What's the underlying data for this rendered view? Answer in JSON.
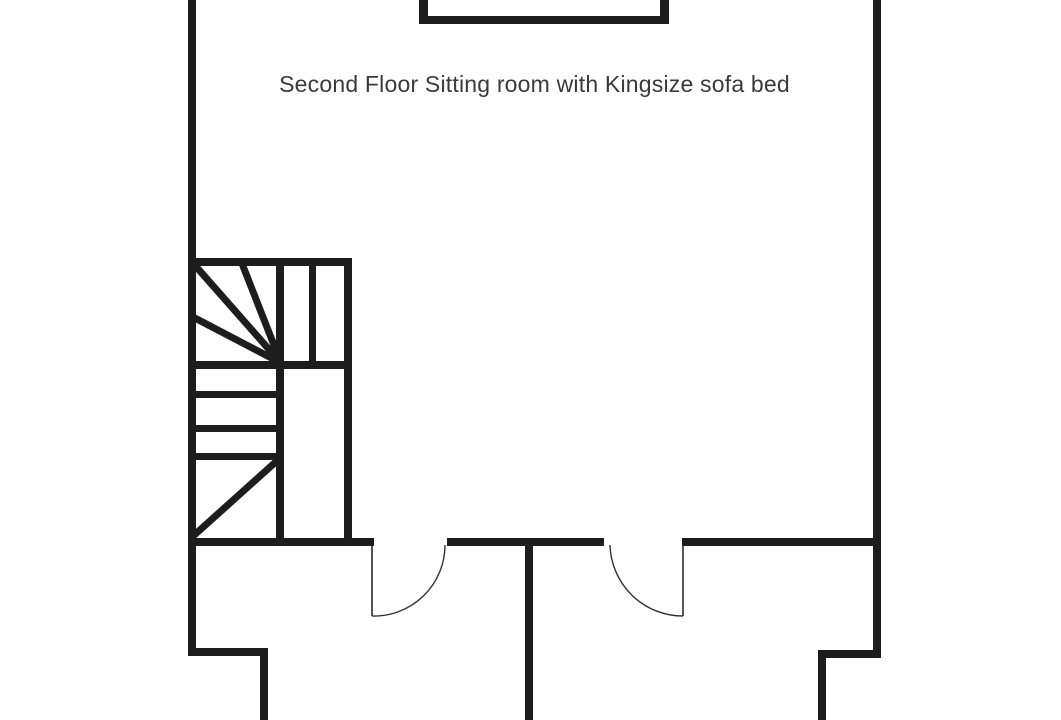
{
  "title": {
    "label": "Second Floor Sitting room with Kingsize sofa bed"
  },
  "colors": {
    "background": "#ffffff",
    "wall": "#1d1d1d",
    "door_leaf": "#555555",
    "door_arc": "#333333",
    "text": "#3a3a3a"
  },
  "floorplan": {
    "canvas": {
      "width": 1061,
      "height": 720
    },
    "winder_stroke_width": 7,
    "door_leaf_stroke_width": 2,
    "door_arc_stroke_width": 1.4,
    "walls": [
      {
        "name": "left-exterior-wall",
        "x": 188,
        "y": 0,
        "w": 8,
        "h": 656
      },
      {
        "name": "right-exterior-wall",
        "x": 873,
        "y": 0,
        "w": 8,
        "h": 658
      },
      {
        "name": "chimney-left-wall",
        "x": 419,
        "y": 0,
        "w": 9,
        "h": 24
      },
      {
        "name": "chimney-right-wall",
        "x": 660,
        "y": 0,
        "w": 9,
        "h": 24
      },
      {
        "name": "chimney-bottom-wall",
        "x": 419,
        "y": 16,
        "w": 250,
        "h": 8
      },
      {
        "name": "stair-top-edge",
        "x": 188,
        "y": 258,
        "w": 164,
        "h": 8
      },
      {
        "name": "stair-right-edge",
        "x": 344,
        "y": 258,
        "w": 8,
        "h": 288
      },
      {
        "name": "stair-center-divider",
        "x": 276,
        "y": 258,
        "w": 8,
        "h": 288
      },
      {
        "name": "stair-upper-riser",
        "x": 309,
        "y": 258,
        "w": 7,
        "h": 106
      },
      {
        "name": "stair-mid-landing-edge",
        "x": 188,
        "y": 361,
        "w": 164,
        "h": 8
      },
      {
        "name": "stair-tread-1",
        "x": 188,
        "y": 391,
        "w": 95,
        "h": 7
      },
      {
        "name": "stair-tread-2",
        "x": 188,
        "y": 425,
        "w": 95,
        "h": 7
      },
      {
        "name": "stair-tread-3",
        "x": 188,
        "y": 453,
        "w": 95,
        "h": 7
      },
      {
        "name": "hall-wall-left-segment",
        "x": 188,
        "y": 538,
        "w": 186,
        "h": 8
      },
      {
        "name": "hall-wall-middle-segment",
        "x": 447,
        "y": 538,
        "w": 157,
        "h": 8
      },
      {
        "name": "hall-wall-right-segment",
        "x": 682,
        "y": 538,
        "w": 199,
        "h": 8
      },
      {
        "name": "room-partition-wall",
        "x": 525,
        "y": 538,
        "w": 8,
        "h": 182
      },
      {
        "name": "lower-left-step-wall",
        "x": 188,
        "y": 648,
        "w": 80,
        "h": 8
      },
      {
        "name": "lower-left-return-wall",
        "x": 260,
        "y": 648,
        "w": 8,
        "h": 72
      },
      {
        "name": "lower-right-step-wall",
        "x": 818,
        "y": 650,
        "w": 63,
        "h": 8
      },
      {
        "name": "lower-right-return-wall",
        "x": 818,
        "y": 650,
        "w": 8,
        "h": 70
      }
    ],
    "winder_treads": [
      {
        "name": "winder-tread-1",
        "x1": 281,
        "y1": 363,
        "x2": 192,
        "y2": 262
      },
      {
        "name": "winder-tread-2",
        "x1": 281,
        "y1": 363,
        "x2": 241,
        "y2": 261
      },
      {
        "name": "winder-tread-3",
        "x1": 281,
        "y1": 363,
        "x2": 191,
        "y2": 316
      },
      {
        "name": "winder-tread-4",
        "x1": 191,
        "y1": 538,
        "x2": 279,
        "y2": 459
      }
    ],
    "doors": [
      {
        "name": "left-door",
        "leaf": {
          "x": 372,
          "y1": 546,
          "y2": 616
        },
        "arc": {
          "start_x": 445,
          "start_y": 545,
          "r": 71,
          "end_x": 372,
          "end_y": 616,
          "sweep": 1
        }
      },
      {
        "name": "right-door",
        "leaf": {
          "x": 683,
          "y1": 546,
          "y2": 616
        },
        "arc": {
          "start_x": 610,
          "start_y": 545,
          "r": 73,
          "end_x": 683,
          "end_y": 616,
          "sweep": 0
        }
      }
    ]
  }
}
